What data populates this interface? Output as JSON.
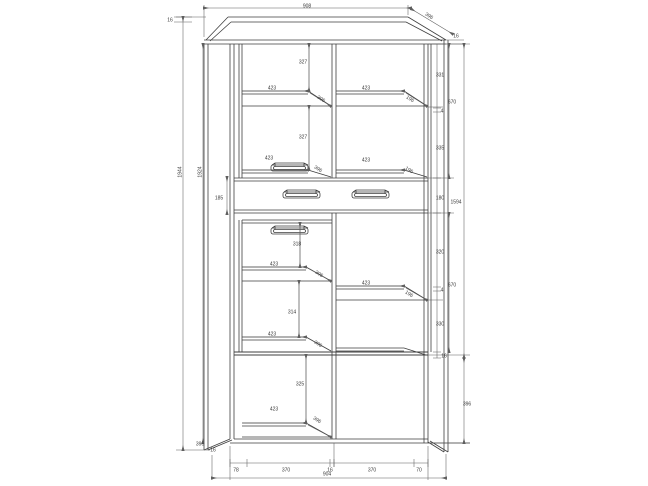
{
  "meta": {
    "kind": "furniture-technical-drawing",
    "subject": "tall two-door display cabinet with centre drawer, front elevation with section shelves",
    "units": "mm"
  },
  "colors": {
    "background": "#ffffff",
    "line": "#3f3f3f",
    "dimension": "#5f5f5f",
    "text": "#3a3a3a"
  },
  "drawing": {
    "overall": {
      "width": "908",
      "height": "1944",
      "depth": "396"
    },
    "labels": [
      {
        "id": "top-width",
        "text": "908",
        "x": 307,
        "y": 6,
        "rot": 0
      },
      {
        "id": "top-depth",
        "text": "396",
        "x": 429,
        "y": 16,
        "rot": 33
      },
      {
        "id": "top-thickness-left",
        "text": "16",
        "x": 170,
        "y": 20,
        "rot": 0
      },
      {
        "id": "top-thickness-right",
        "text": "16",
        "x": 456,
        "y": 36,
        "rot": 0
      },
      {
        "id": "height-outer",
        "text": "1944",
        "x": 180,
        "y": 172,
        "rot": -90
      },
      {
        "id": "height-inner",
        "text": "1924",
        "x": 200,
        "y": 172,
        "rot": -90
      },
      {
        "id": "upper-left-cell-1",
        "text": "327",
        "x": 303,
        "y": 62,
        "rot": 0
      },
      {
        "id": "upper-left-shelf-width-1",
        "text": "423",
        "x": 272,
        "y": 88,
        "rot": 0
      },
      {
        "id": "upper-left-shelf-depth-1",
        "text": "396",
        "x": 321,
        "y": 99,
        "rot": 33
      },
      {
        "id": "upper-left-cell-2",
        "text": "327",
        "x": 303,
        "y": 137,
        "rot": 0
      },
      {
        "id": "upper-left-shelf-width-2",
        "text": "423",
        "x": 269,
        "y": 158,
        "rot": 0
      },
      {
        "id": "upper-left-shelf-depth-2",
        "text": "396",
        "x": 318,
        "y": 169,
        "rot": 33
      },
      {
        "id": "upper-right-shelf-width-1",
        "text": "423",
        "x": 366,
        "y": 88,
        "rot": 0
      },
      {
        "id": "upper-right-shelf-depth-1",
        "text": "196",
        "x": 410,
        "y": 99,
        "rot": 33
      },
      {
        "id": "upper-right-shelf-width-2",
        "text": "423",
        "x": 366,
        "y": 160,
        "rot": 0
      },
      {
        "id": "upper-right-shelf-depth-2",
        "text": "196",
        "x": 409,
        "y": 170,
        "rot": 33
      },
      {
        "id": "upper-right-cell-1",
        "text": "331",
        "x": 440,
        "y": 75,
        "rot": 0
      },
      {
        "id": "upper-shelf-thickness",
        "text": "4",
        "x": 442,
        "y": 111,
        "rot": 0
      },
      {
        "id": "upper-right-cell-2",
        "text": "335",
        "x": 440,
        "y": 148,
        "rot": 0
      },
      {
        "id": "upper-door-height",
        "text": "670",
        "x": 452,
        "y": 102,
        "rot": 0
      },
      {
        "id": "drawer-height-left",
        "text": "185",
        "x": 219,
        "y": 198,
        "rot": 0
      },
      {
        "id": "drawer-height-right",
        "text": "180",
        "x": 440,
        "y": 198,
        "rot": 0
      },
      {
        "id": "lower-left-cell-1",
        "text": "318",
        "x": 297,
        "y": 244,
        "rot": 0
      },
      {
        "id": "lower-left-shelf-width-1",
        "text": "423",
        "x": 274,
        "y": 264,
        "rot": 0
      },
      {
        "id": "lower-left-shelf-depth-1",
        "text": "396",
        "x": 319,
        "y": 274,
        "rot": 33
      },
      {
        "id": "lower-left-cell-2",
        "text": "314",
        "x": 292,
        "y": 312,
        "rot": 0
      },
      {
        "id": "lower-left-shelf-width-2",
        "text": "423",
        "x": 272,
        "y": 334,
        "rot": 0
      },
      {
        "id": "lower-left-shelf-depth-2",
        "text": "396",
        "x": 318,
        "y": 344,
        "rot": 33
      },
      {
        "id": "lower-right-shelf-width",
        "text": "423",
        "x": 366,
        "y": 283,
        "rot": 0
      },
      {
        "id": "lower-right-shelf-depth",
        "text": "196",
        "x": 409,
        "y": 294,
        "rot": 33
      },
      {
        "id": "lower-right-cell-1",
        "text": "320",
        "x": 440,
        "y": 252,
        "rot": 0
      },
      {
        "id": "lower-shelf-thickness",
        "text": "4",
        "x": 442,
        "y": 290,
        "rot": 0
      },
      {
        "id": "lower-right-cell-2",
        "text": "330",
        "x": 440,
        "y": 324,
        "rot": 0
      },
      {
        "id": "lower-bottom-thickness",
        "text": "16",
        "x": 444,
        "y": 356,
        "rot": 0
      },
      {
        "id": "lower-door-height",
        "text": "670",
        "x": 452,
        "y": 285,
        "rot": 0
      },
      {
        "id": "right-span-upper",
        "text": "1594",
        "x": 456,
        "y": 202,
        "rot": 0
      },
      {
        "id": "right-span-lower",
        "text": "396",
        "x": 467,
        "y": 404,
        "rot": 0
      },
      {
        "id": "base-cell",
        "text": "325",
        "x": 300,
        "y": 384,
        "rot": 0
      },
      {
        "id": "base-shelf-width",
        "text": "423",
        "x": 274,
        "y": 409,
        "rot": 0
      },
      {
        "id": "base-shelf-depth",
        "text": "396",
        "x": 317,
        "y": 420,
        "rot": 33
      },
      {
        "id": "foot-depth",
        "text": "396",
        "x": 200,
        "y": 444,
        "rot": 0
      },
      {
        "id": "foot-thickness",
        "text": "16",
        "x": 213,
        "y": 450,
        "rot": 0
      },
      {
        "id": "bottom-seg-1",
        "text": "78",
        "x": 236,
        "y": 470,
        "rot": 0
      },
      {
        "id": "bottom-seg-2",
        "text": "370",
        "x": 286,
        "y": 470,
        "rot": 0
      },
      {
        "id": "bottom-seg-3",
        "text": "16",
        "x": 330,
        "y": 470,
        "rot": 0
      },
      {
        "id": "bottom-seg-4",
        "text": "370",
        "x": 372,
        "y": 470,
        "rot": 0
      },
      {
        "id": "bottom-seg-5",
        "text": "70",
        "x": 419,
        "y": 470,
        "rot": 0
      },
      {
        "id": "bottom-overall",
        "text": "904",
        "x": 327,
        "y": 474,
        "rot": 0
      }
    ]
  }
}
